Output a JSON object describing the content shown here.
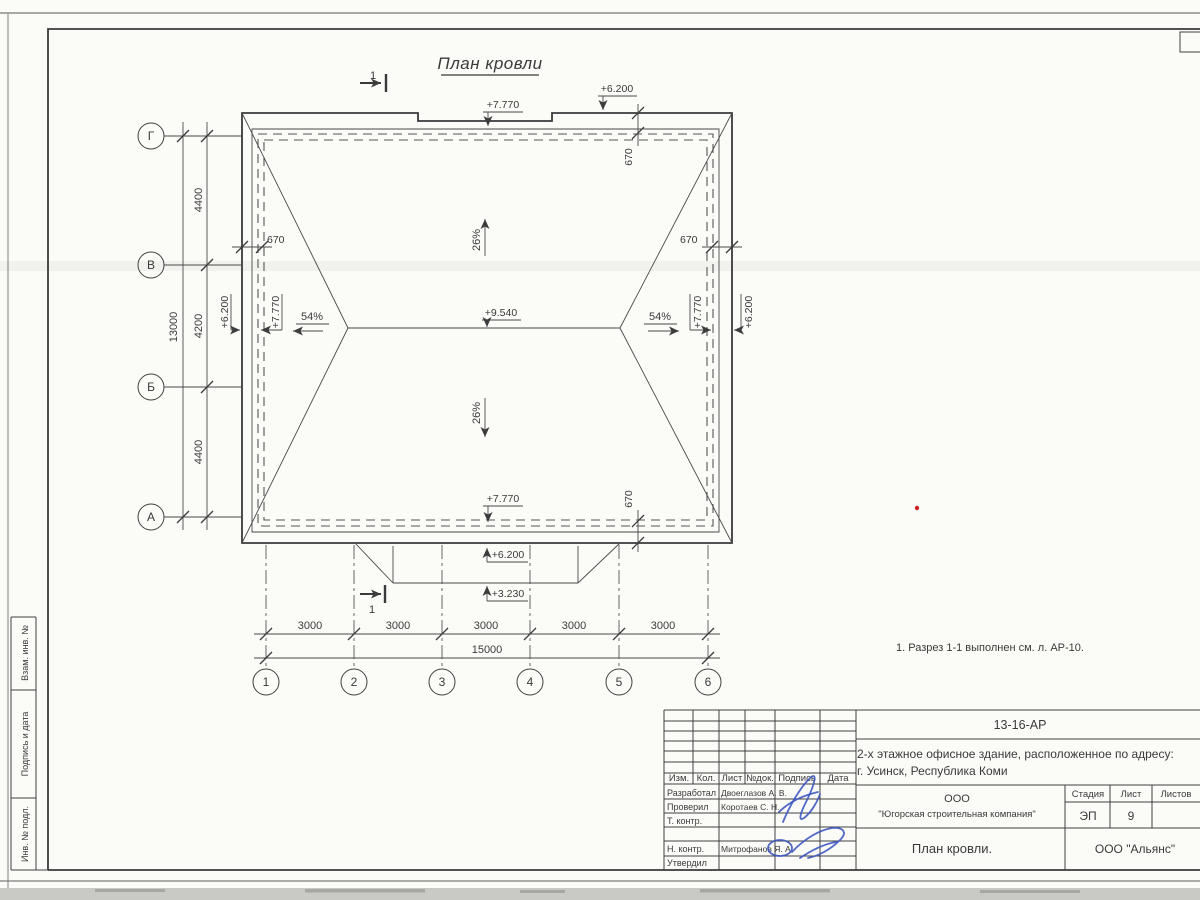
{
  "sheet": {
    "title": "План кровли",
    "note": "1. Разрез 1-1 выполнен см. л. АР-10.",
    "section_mark": "1"
  },
  "plan": {
    "slopes": {
      "main": "26%",
      "end": "54%"
    },
    "elevations": {
      "ridge": "+9.540",
      "upper_eave": "+7.770",
      "lower_eave": "+6.200",
      "canopy": "+3.230"
    },
    "axes": {
      "horizontal": [
        "Г",
        "В",
        "Б",
        "А"
      ],
      "vertical": [
        "1",
        "2",
        "3",
        "4",
        "5",
        "6"
      ]
    },
    "dims": {
      "left_segments": [
        "4400",
        "4200",
        "4400"
      ],
      "left_total": "13000",
      "bottom_segments": [
        "3000",
        "3000",
        "3000",
        "3000",
        "3000"
      ],
      "bottom_total": "15000",
      "eave_offset": "670"
    }
  },
  "stamp_side": {
    "boxes": [
      "Взам. инв. №",
      "Подпись и дата",
      "Инв. № подл."
    ]
  },
  "titleblock": {
    "doc_number": "13-16-АР",
    "object_line1": "2-х этажное офисное здание, расположенное по адресу:",
    "object_line2": "г. Усинск, Республика Коми",
    "columns": [
      "Изм.",
      "Кол.",
      "Лист",
      "№док.",
      "Подпись",
      "Дата"
    ],
    "roles": [
      "Разработал",
      "Проверил",
      "Т. контр.",
      "Н. контр.",
      "Утвердил"
    ],
    "names": {
      "developed": "Двоеглазов А. В.",
      "checked": "Коротаев С. Н.",
      "ncontrol": "Митрофанов Я. А."
    },
    "company_line1": "ООО",
    "company_line2": "\"Югорская строительная компания\"",
    "stage_label": "Стадия",
    "sheet_label": "Лист",
    "sheets_label": "Листов",
    "stage": "ЭП",
    "sheet_number": "9",
    "drawing_title": "План кровли.",
    "contractor": "ООО \"Альянс\""
  }
}
